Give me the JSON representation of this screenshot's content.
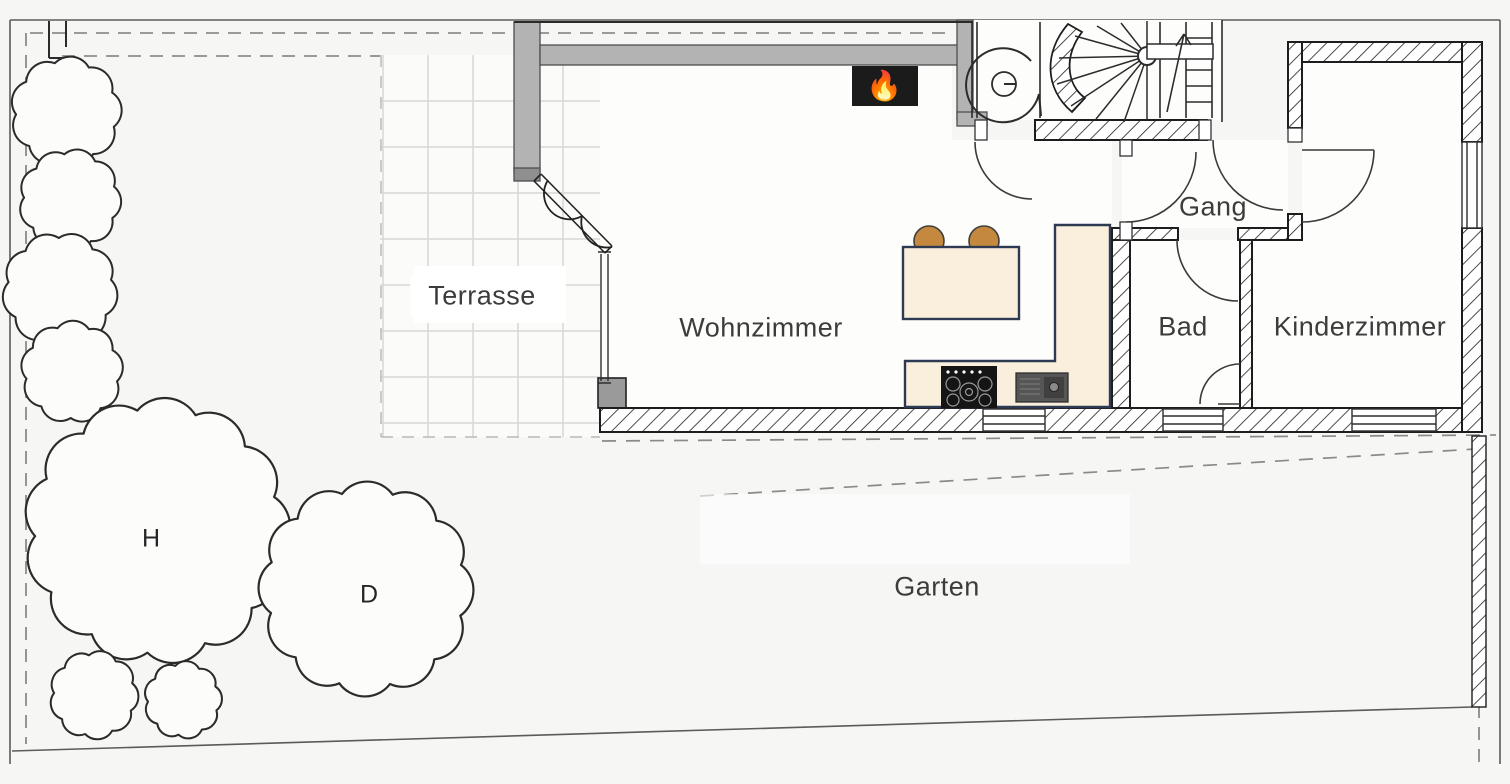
{
  "plan": {
    "title": "Erdgeschoss Grundriss",
    "rooms": [
      {
        "id": "terrasse",
        "label": "Terrasse"
      },
      {
        "id": "wohnzimmer",
        "label": "Wohnzimmer"
      },
      {
        "id": "gang",
        "label": "Gang"
      },
      {
        "id": "bad",
        "label": "Bad"
      },
      {
        "id": "kinderzimmer",
        "label": "Kinderzimmer"
      },
      {
        "id": "garten",
        "label": "Garten"
      }
    ],
    "tree_marks": [
      {
        "id": "tree-1",
        "label": "H"
      },
      {
        "id": "tree-2",
        "label": "D"
      }
    ],
    "fireplace": {
      "glyph": "🔥"
    },
    "colors": {
      "wall_gray": "#b3b3b3",
      "wall_line": "#1d1d1d",
      "counter_cream": "#faefdc",
      "counter_border": "#2e3a52",
      "stool_brown": "#c4893f",
      "stove_black": "#151515",
      "sink_gray": "#565656",
      "fireplace_black": "#1b1b1b",
      "grid_gray": "#d8d8d6",
      "boundary_dash": "#7c7c7c",
      "paper": "#f6f6f4",
      "floor_white": "#fdfdfc"
    }
  }
}
